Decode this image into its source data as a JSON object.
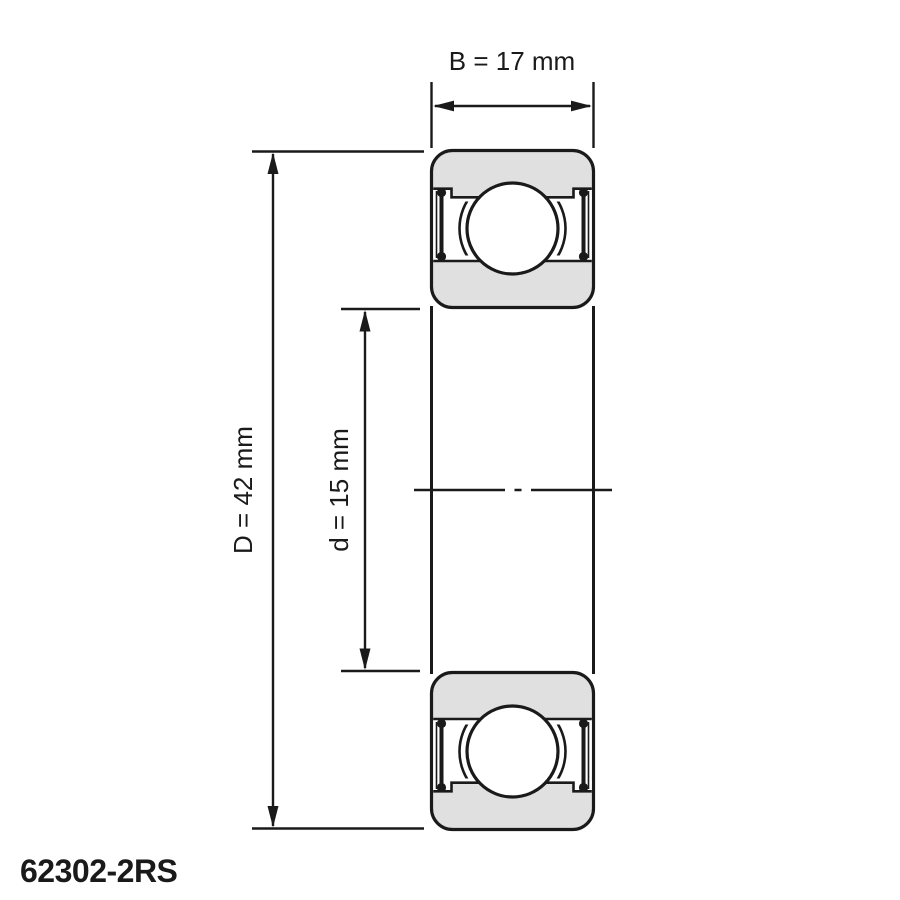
{
  "diagram": {
    "part_label": "62302-2RS",
    "dimensions": {
      "width_label": "B = 17 mm",
      "outer_diameter_label": "D = 42 mm",
      "bore_diameter_label": "d = 15 mm",
      "width_mm": 17,
      "outer_diameter_mm": 42,
      "bore_diameter_mm": 15
    },
    "colors": {
      "line": "#1a1a1a",
      "body_fill": "#e0e0e0",
      "background": "#ffffff"
    }
  }
}
